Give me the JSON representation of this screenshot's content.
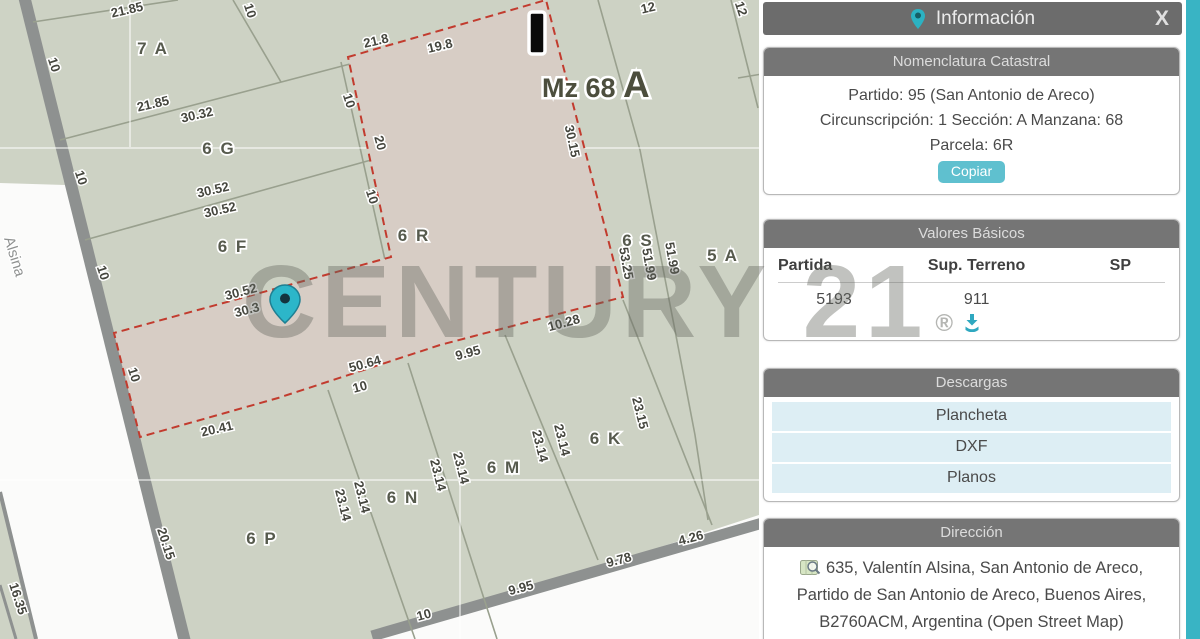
{
  "watermark": {
    "text": "CENTURY 21",
    "registered": "®"
  },
  "map": {
    "street_label": "Alsina",
    "block_label": {
      "prefix": "Mz 68",
      "suffix": "A"
    },
    "colors": {
      "parcel_fill": "#cdd2c4",
      "selected_fill": "#d7cdc5",
      "selected_border": "#c23b2e",
      "road": "#8e9190",
      "pin": "#2cb6c9"
    },
    "parcel_labels": [
      {
        "t": "7 A",
        "x": 153,
        "y": 54
      },
      {
        "t": "6 G",
        "x": 219,
        "y": 154
      },
      {
        "t": "6 F",
        "x": 233,
        "y": 252
      },
      {
        "t": "6 R",
        "x": 414,
        "y": 241
      },
      {
        "t": "6 S",
        "x": 638,
        "y": 246
      },
      {
        "t": "5 A",
        "x": 723,
        "y": 261
      },
      {
        "t": "6 K",
        "x": 606,
        "y": 444
      },
      {
        "t": "6 M",
        "x": 504,
        "y": 473
      },
      {
        "t": "6 N",
        "x": 403,
        "y": 503
      },
      {
        "t": "6 P",
        "x": 262,
        "y": 544
      }
    ],
    "dimension_labels": [
      {
        "t": "21.85",
        "x": 128,
        "y": 14,
        "r": -13
      },
      {
        "t": "10",
        "x": 246,
        "y": 12,
        "r": 72
      },
      {
        "t": "21.8",
        "x": 377,
        "y": 45,
        "r": -13
      },
      {
        "t": "19.8",
        "x": 441,
        "y": 50,
        "r": -13
      },
      {
        "t": "12",
        "x": 649,
        "y": 12,
        "r": -13
      },
      {
        "t": "12",
        "x": 737,
        "y": 10,
        "r": 72
      },
      {
        "t": "10",
        "x": 50,
        "y": 66,
        "r": 72
      },
      {
        "t": "21.85",
        "x": 154,
        "y": 108,
        "r": -13
      },
      {
        "t": "30.32",
        "x": 198,
        "y": 119,
        "r": -13
      },
      {
        "t": "10",
        "x": 345,
        "y": 102,
        "r": 72
      },
      {
        "t": "20",
        "x": 376,
        "y": 144,
        "r": 75
      },
      {
        "t": "30.15",
        "x": 568,
        "y": 142,
        "r": 78
      },
      {
        "t": "10",
        "x": 77,
        "y": 179,
        "r": 72
      },
      {
        "t": "30.52",
        "x": 214,
        "y": 194,
        "r": -13
      },
      {
        "t": "30.52",
        "x": 221,
        "y": 214,
        "r": -13
      },
      {
        "t": "10",
        "x": 368,
        "y": 198,
        "r": 72
      },
      {
        "t": "10",
        "x": 99,
        "y": 274,
        "r": 72
      },
      {
        "t": "53.25",
        "x": 622,
        "y": 264,
        "r": 80
      },
      {
        "t": "51.99",
        "x": 645,
        "y": 265,
        "r": 80
      },
      {
        "t": "51.99",
        "x": 668,
        "y": 259,
        "r": 80
      },
      {
        "t": "30.52",
        "x": 242,
        "y": 296,
        "r": -15
      },
      {
        "t": "30.3",
        "x": 248,
        "y": 314,
        "r": -15
      },
      {
        "t": "10.28",
        "x": 565,
        "y": 327,
        "r": -15
      },
      {
        "t": "9.95",
        "x": 469,
        "y": 357,
        "r": -15
      },
      {
        "t": "50.64",
        "x": 366,
        "y": 368,
        "r": -15
      },
      {
        "t": "10",
        "x": 130,
        "y": 376,
        "r": 72
      },
      {
        "t": "10",
        "x": 361,
        "y": 391,
        "r": -15
      },
      {
        "t": "20.41",
        "x": 218,
        "y": 433,
        "r": -13
      },
      {
        "t": "23.15",
        "x": 636,
        "y": 414,
        "r": 76
      },
      {
        "t": "23.14",
        "x": 558,
        "y": 441,
        "r": 76
      },
      {
        "t": "23.14",
        "x": 536,
        "y": 447,
        "r": 76
      },
      {
        "t": "23.14",
        "x": 457,
        "y": 469,
        "r": 76
      },
      {
        "t": "23.14",
        "x": 434,
        "y": 476,
        "r": 76
      },
      {
        "t": "23.14",
        "x": 358,
        "y": 498,
        "r": 76
      },
      {
        "t": "23.14",
        "x": 339,
        "y": 506,
        "r": 76
      },
      {
        "t": "20.15",
        "x": 162,
        "y": 545,
        "r": 72
      },
      {
        "t": "4.26",
        "x": 692,
        "y": 542,
        "r": -15
      },
      {
        "t": "9.78",
        "x": 620,
        "y": 564,
        "r": -15
      },
      {
        "t": "9.95",
        "x": 522,
        "y": 592,
        "r": -15
      },
      {
        "t": "10",
        "x": 425,
        "y": 619,
        "r": -15
      },
      {
        "t": "16.35",
        "x": 14,
        "y": 600,
        "r": 72
      }
    ]
  },
  "panel": {
    "title": "Información",
    "close_label": "X",
    "nomenclatura": {
      "title": "Nomenclatura Catastral",
      "lines": [
        "Partido: 95 (San Antonio de Areco)",
        "Circunscripción: 1 Sección: A Manzana: 68",
        "Parcela: 6R"
      ],
      "copy_label": "Copiar"
    },
    "valores": {
      "title": "Valores Básicos",
      "columns": [
        "Partida",
        "Sup. Terreno",
        "SP"
      ],
      "row": {
        "partida": "5193",
        "sup_terreno": "911",
        "sp": ""
      }
    },
    "descargas": {
      "title": "Descargas",
      "items": [
        "Plancheta",
        "DXF",
        "Planos"
      ]
    },
    "direccion": {
      "title": "Dirección",
      "text": "635, Valentín Alsina, San Antonio de Areco, Partido de San Antonio de Areco, Buenos Aires, B2760ACM, Argentina (Open Street Map)"
    }
  }
}
